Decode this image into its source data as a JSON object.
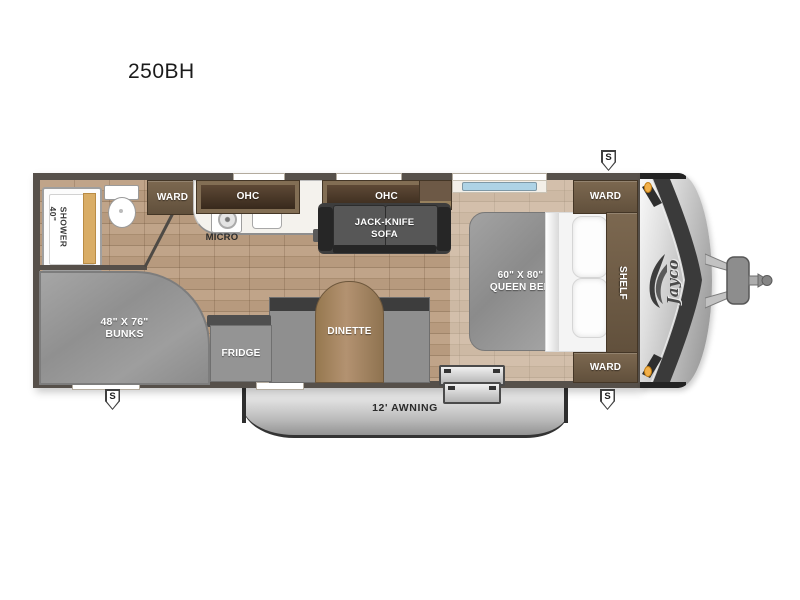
{
  "title": "250BH",
  "floorplan": {
    "labels": {
      "ward_bath": "WARD",
      "ohc_kitchen": "OHC",
      "micro": "MICRO",
      "ohc_living": "OHC",
      "sofa_line1": "JACK-KNIFE",
      "sofa_line2": "SOFA",
      "shower": "40\"\nSHOWER",
      "bunks_line1": "48\" X 76\"",
      "bunks_line2": "BUNKS",
      "fridge": "FRIDGE",
      "dinette": "DINETTE",
      "bed_line1": "60\" X 80\"",
      "bed_line2": "QUEEN BED",
      "ward_front_top": "WARD",
      "shelf": "SHELF",
      "ward_front_bottom": "WARD",
      "awning": "12' AWNING",
      "brand": "Jayco",
      "speaker": "S"
    },
    "colors": {
      "wall": "#56504a",
      "floor_wood": "#b79a7e",
      "cabinet_brown": "#6d5946",
      "cabinet_panel_dark": "#38291c",
      "counter_white": "#f4f2ed",
      "upholstery_gray": "#8f8f8f",
      "sofa_dark": "#3d3d3d",
      "table_wood": "#a3835f",
      "awning_silver": "#c9c9c9",
      "nose_accent": "#3a3a3a",
      "amber_light": "#f2b04a",
      "shower_door_tan": "#d9ad66"
    }
  }
}
